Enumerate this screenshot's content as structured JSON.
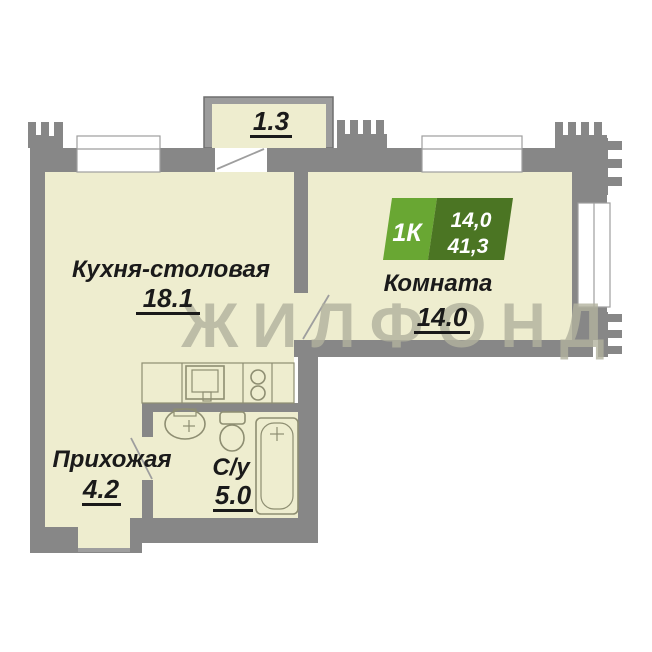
{
  "watermark": {
    "text": "ЖИЛФОНД"
  },
  "badge": {
    "rooms": "1К",
    "living_area": "14,0",
    "total_area": "41,3"
  },
  "rooms": {
    "kitchen": {
      "name": "Кухня-столовая",
      "area": "18.1"
    },
    "living": {
      "name": "Комната",
      "area": "14.0"
    },
    "hallway": {
      "name": "Прихожая",
      "area": "4.2"
    },
    "bathroom": {
      "name": "С/у",
      "area": "5.0"
    },
    "balcony": {
      "area": "1.3"
    }
  },
  "colors": {
    "floor": "#EEEDCF",
    "wall": "#878787",
    "window": "#FFFFFF",
    "frame": "#9E9E9E",
    "fixture": "#8E8E72",
    "label": "#1A1A1A",
    "watermark": "#B2B29E",
    "badge_light": "#69A733",
    "badge_dark": "#4B7523",
    "balcony_wall": "#9C9C9C",
    "balcony_edge": "#6E6E6E"
  }
}
